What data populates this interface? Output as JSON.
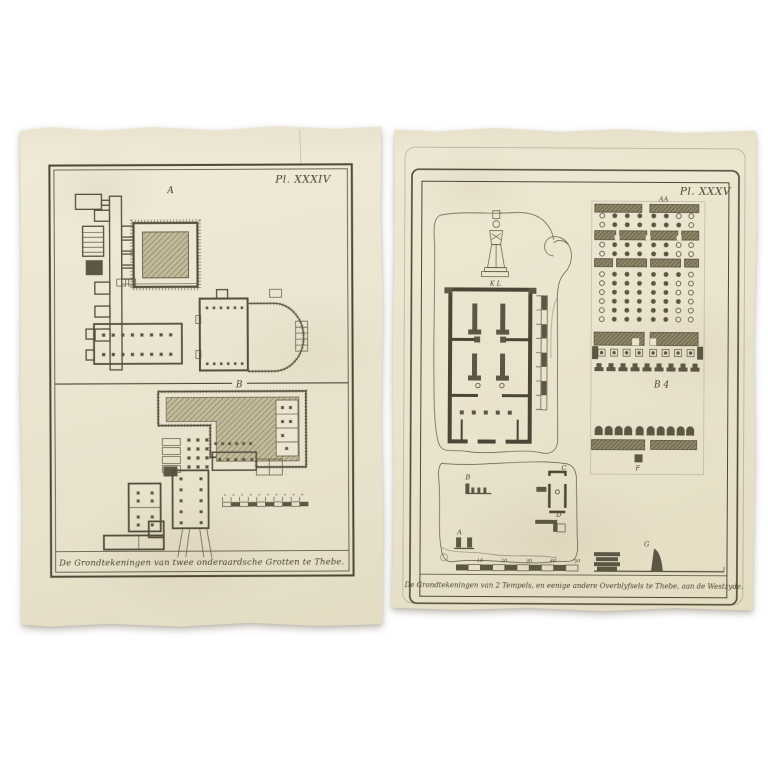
{
  "scene": {
    "background_color": "#ffffff"
  },
  "left_print": {
    "plate_number": "Pl. XXXIV",
    "section_a_label": "A",
    "section_b_label": "B",
    "caption": "De Grondtekeningen van twee onderaardsche Grotten te Thebe.",
    "colors": {
      "paper": "#ebe5d1",
      "ink": "#4d4738"
    }
  },
  "right_print": {
    "plate_number": "Pl. XXXV",
    "plan_label": "AA",
    "statue_label": "K L",
    "label_b4": "B 4",
    "label_f": "F",
    "label_g": "G",
    "fragment_labels": {
      "a": "A",
      "b": "B",
      "c": "C",
      "d": "D"
    },
    "scale_numbers": [
      "10",
      "20",
      "30",
      "40",
      "50"
    ],
    "caption": "De Grondtekeningen van 2 Tempels, en eenige andere Overblyfsels te Thebe, aan de Westzyde.",
    "colors": {
      "paper": "#e9e2cc",
      "ink": "#4d4738"
    }
  }
}
